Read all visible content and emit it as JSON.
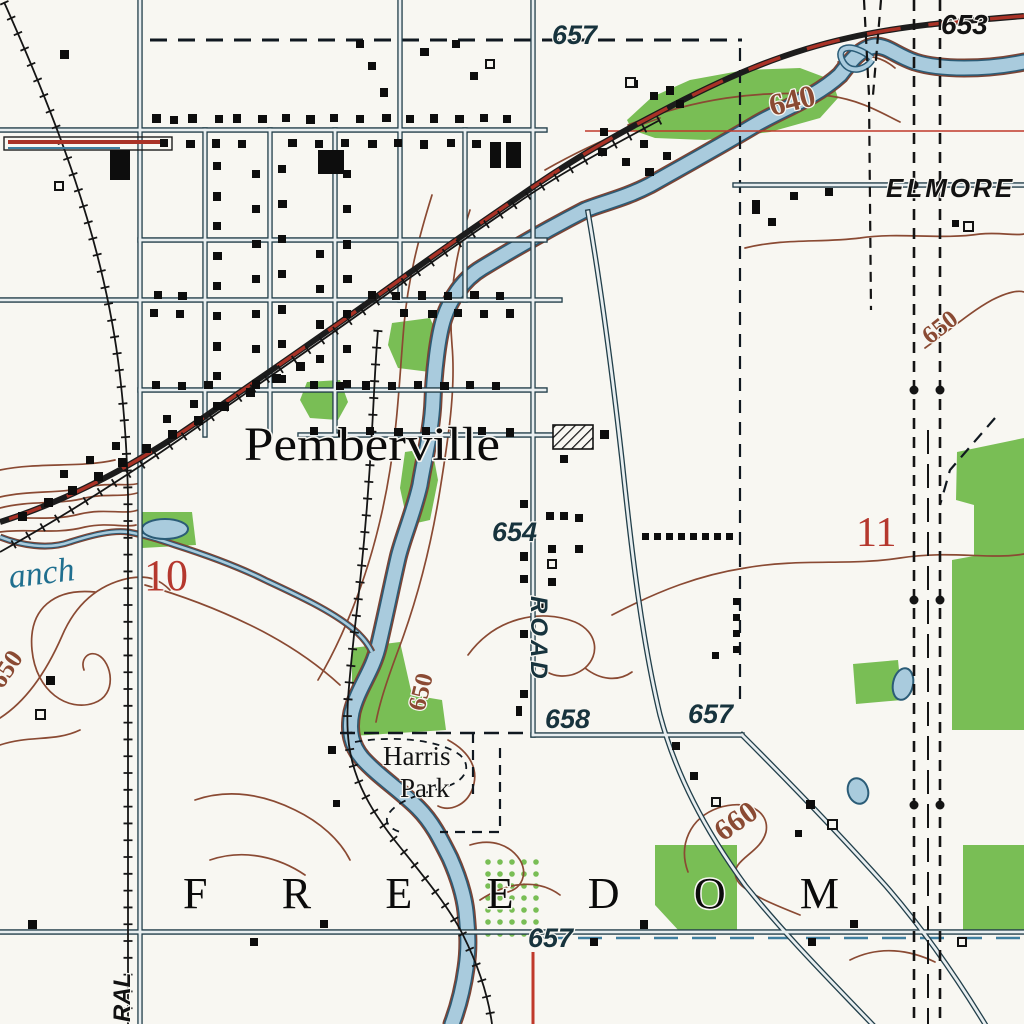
{
  "map": {
    "town_name": "Pemberville",
    "township_name": "FREEDOM",
    "park": {
      "line1": "Harris",
      "line2": "Park"
    },
    "road_destination": "ELMORE",
    "vertical_road_name": "ROAD",
    "street_fragment": "RAL",
    "stream_fragment": "anch",
    "spot_elevations": [
      {
        "text": "657"
      },
      {
        "text": "653"
      },
      {
        "text": "654"
      },
      {
        "text": "658"
      },
      {
        "text": "657"
      },
      {
        "text": "657"
      }
    ],
    "contour_labels": [
      {
        "text": "640"
      },
      {
        "text": "650"
      },
      {
        "text": "650"
      },
      {
        "text": "650"
      },
      {
        "text": "660"
      }
    ],
    "section_numbers": [
      {
        "text": "10"
      },
      {
        "text": "11"
      }
    ],
    "colors": {
      "background": "#f8f7f2",
      "water_fill": "#a9cbdd",
      "water_edge": "#2b5c77",
      "bank_brown": "#7d4434",
      "woodland_green": "#79be55",
      "contour_brown": "#8a4a33",
      "highway_red": "#a93226",
      "section_line_red": "#c0392b",
      "section_number_red": "#b5382e",
      "road_fill": "#e8eef0",
      "road_casing": "#223f4a",
      "ink_black": "#121212",
      "elevation_slate": "#17333d",
      "stream_label_blue": "#1f6f8f"
    }
  }
}
